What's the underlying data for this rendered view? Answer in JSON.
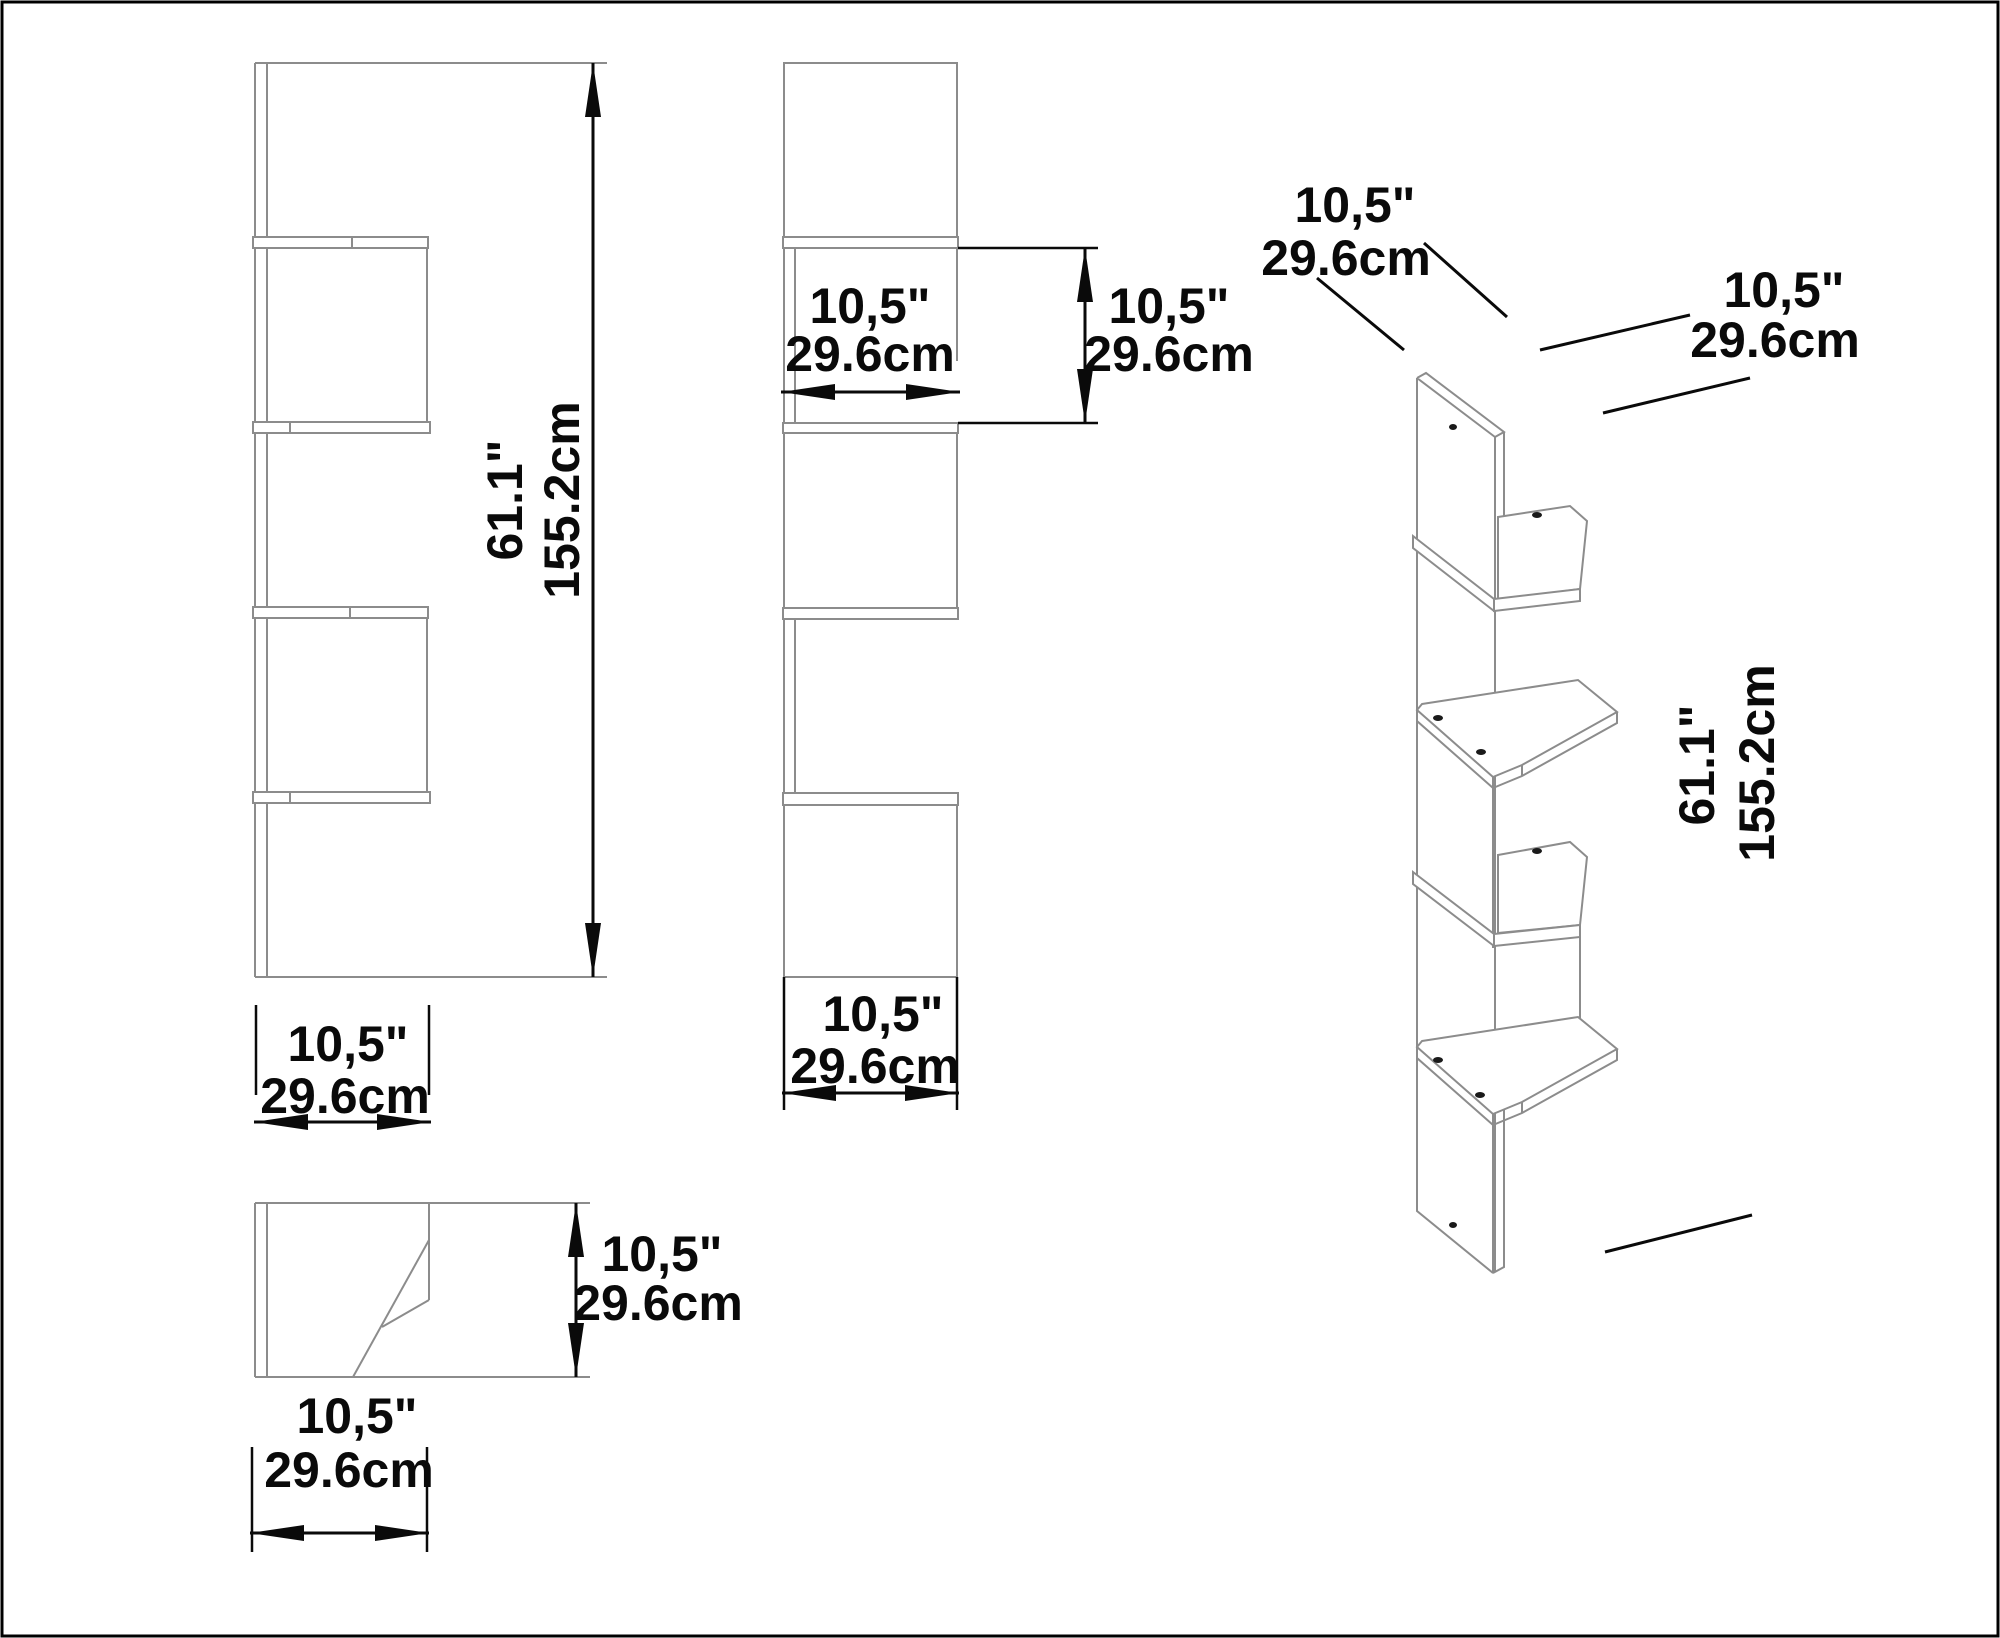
{
  "diagram_title": "corner-shelf-dimension-drawing",
  "units": {
    "imperial": "inches",
    "metric": "cm"
  },
  "front_view": {
    "height_in": "61.1\"",
    "height_cm": "155.2cm",
    "width_in": "10,5\"",
    "width_cm": "29.6cm"
  },
  "side_view": {
    "compartment_width_in": "10,5\"",
    "compartment_width_cm": "29.6cm",
    "compartment_height_in": "10,5\"",
    "compartment_height_cm": "29.6cm",
    "width_in": "10,5\"",
    "width_cm": "29.6cm"
  },
  "top_view": {
    "depth_in": "10,5\"",
    "depth_cm": "29.6cm",
    "width_in": "10,5\"",
    "width_cm": "29.6cm"
  },
  "perspective_view": {
    "back_width_in": "10,5\"",
    "back_width_cm": "29.6cm",
    "side_width_in": "10,5\"",
    "side_width_cm": "29.6cm",
    "height_in": "61.1\"",
    "height_cm": "155.2cm"
  }
}
